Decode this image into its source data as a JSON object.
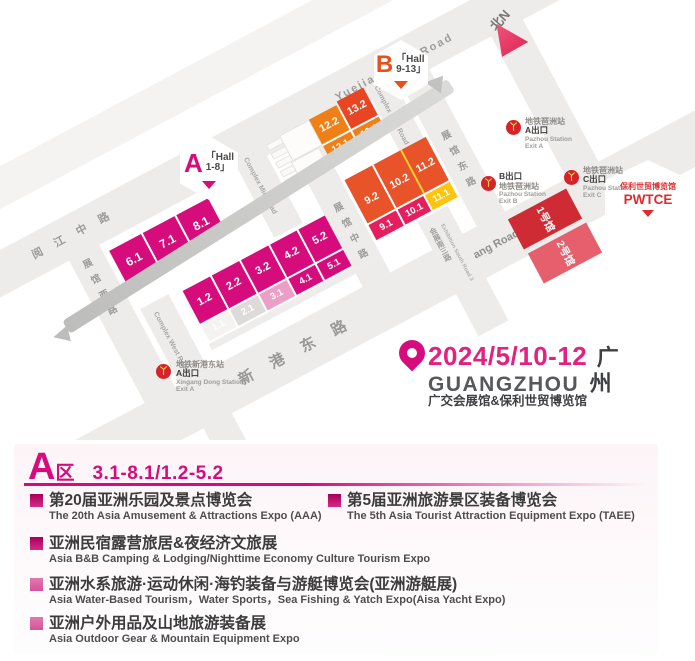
{
  "map": {
    "compass_label": "北N",
    "badge_a": {
      "letter": "A",
      "line1": "「Hall",
      "line2": "1-8」"
    },
    "badge_b": {
      "letter": "B",
      "line1": "「Hall",
      "line2": "9-13」"
    },
    "pwtce_badge": {
      "cn": "保利世贸博览馆",
      "en": "PWTCE"
    },
    "roads": {
      "yuejiang_cn": "阅江中路",
      "yuejiang_en": "Yuejiang Mid Road",
      "complex_mid": "Complex Mid Road",
      "complex_east": "Complex East Road",
      "complex_west": "Complex West Road",
      "hall_west": "展馆西路",
      "hall_mid": "展馆中路",
      "hall_east": "展馆东路",
      "xingang_cn": "新港东路",
      "xingang_en": "Xingang Road East",
      "south3_cn": "会展南三路",
      "south3_en": "Exhibition South Road 3"
    },
    "halls": {
      "a_top": [
        "6.1",
        "7.1",
        "8.1"
      ],
      "a_mid": [
        "1.2",
        "2.2",
        "3.2",
        "4.2",
        "5.2"
      ],
      "a_low": [
        "1.1",
        "2.1",
        "3.1",
        "4.1",
        "5.1"
      ],
      "b12": [
        "12.2",
        "12.1"
      ],
      "b13": [
        "13.2",
        "13.1"
      ],
      "b_mid": [
        "9.2",
        "10.2",
        "11.2"
      ],
      "b_low": [
        "9.1",
        "10.1",
        "11.1"
      ],
      "pwtce": [
        "1号馆",
        "2号馆"
      ]
    },
    "stations": [
      {
        "l1": "地铁琶洲站",
        "l2": "A出口",
        "l3": "Pazhou Station",
        "l4": "Exit A"
      },
      {
        "l1": "B出口",
        "l2": "地铁琶洲站",
        "l3": "Pazhou Station",
        "l4": "Exit B"
      },
      {
        "l1": "地铁琶洲站",
        "l2": "C出口",
        "l3": "Pazhou Station",
        "l4": "Exit C"
      },
      {
        "l1": "地铁新港东站",
        "l2": "A出口",
        "l3": "Xingang Dong Station",
        "l4": "Exit A"
      }
    ],
    "event": {
      "date": "2024/5/10-12",
      "city_cn1": "广",
      "city_en": "GUANGZHOU",
      "city_cn2": "州",
      "venue": "广交会展馆&保利世贸博览馆"
    }
  },
  "panel": {
    "zone_letter": "A",
    "zone_suffix": "区",
    "zone_range": "3.1-8.1/1.2-5.2",
    "items": [
      {
        "title": "第20届亚洲乐园及景点博览会",
        "subtitle": "The 20th Asia Amusement & Attractions Expo (AAA)"
      },
      {
        "title": "第5届亚洲旅游景区装备博览会",
        "subtitle": "The 5th Asia Tourist Attraction Equipment Expo (TAEE)"
      },
      {
        "title": "亚洲民宿露营旅居&夜经济文旅展",
        "subtitle": "Asia B&B Camping & Lodging/Nighttime Economy Culture Tourism Expo"
      },
      {
        "title": "亚洲水系旅游·运动休闲·海钓装备与游艇博览会(亚洲游艇展)",
        "subtitle": "Asia Water-Based Tourism，Water Sports，Sea Fishing & Yatch Expo(Aisa Yacht Expo)"
      },
      {
        "title": "亚洲户外用品及山地旅游装备展",
        "subtitle": "Asia Outdoor Gear & Mountain Equipment Expo"
      }
    ]
  },
  "colors": {
    "magenta": "#d60b7c",
    "orange": "#ef8018",
    "orange_red": "#e8532a",
    "red_13_2": "#e84523",
    "pink_strip": "#e61e5e",
    "yellow": "#ffc40d",
    "red_hall_1": "#cf2b34",
    "red_hall_2": "#e5606c",
    "metro_red": "#d5232a",
    "metro_yellow": "#ffd34d"
  }
}
